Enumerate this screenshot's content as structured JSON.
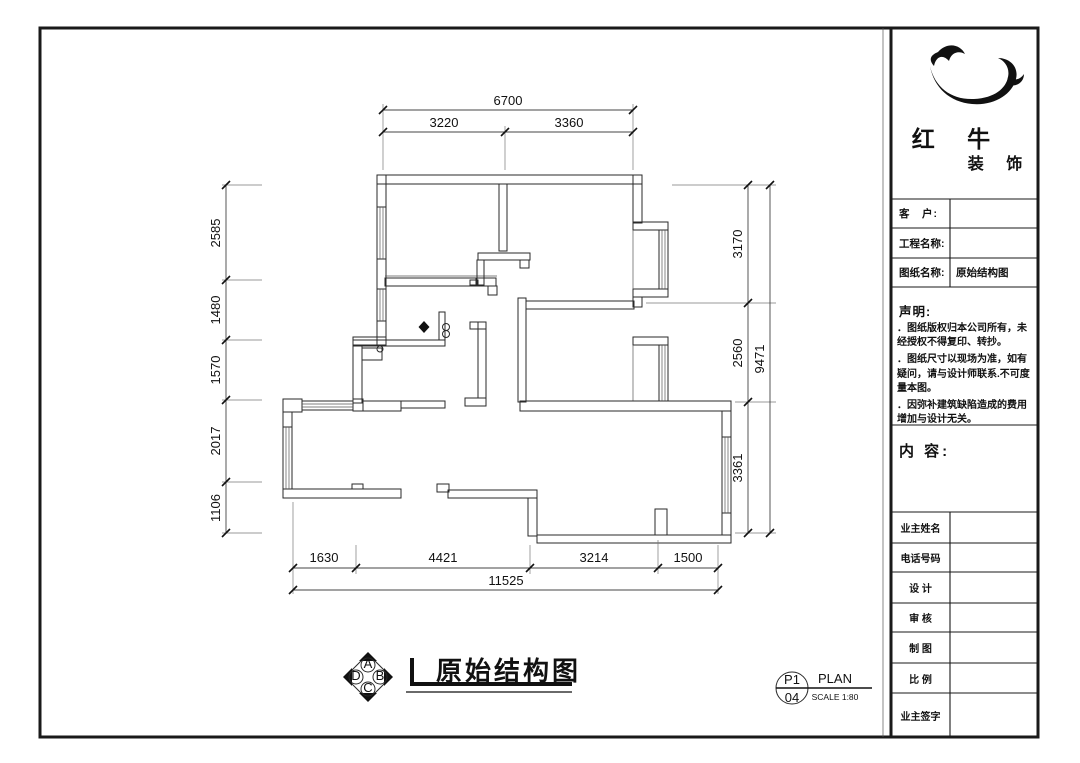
{
  "dims": {
    "top_total": "6700",
    "top_segments": [
      "3220",
      "3360"
    ],
    "left_segments": [
      "2585",
      "1480",
      "1570",
      "2017",
      "1106"
    ],
    "right_segments": [
      "3170",
      "2560",
      "3361"
    ],
    "right_total": "9471",
    "bottom_segments": [
      "1630",
      "4421",
      "3214",
      "1500"
    ],
    "bottom_total": "11525"
  },
  "footer": {
    "title": "原始结构图",
    "marker": {
      "page": "P1",
      "number": "04",
      "type": "PLAN",
      "scale": "SCALE 1:80"
    },
    "compass": {
      "top": "A",
      "right": "B",
      "bottom": "C",
      "left": "D"
    }
  },
  "title_block": {
    "company": {
      "name": "红 牛",
      "suffix": "装 饰"
    },
    "client_label": "客　户:",
    "project_label": "工程名称:",
    "drawing_label": "图纸名称:",
    "drawing_value": "原始结构图",
    "statement_heading": "声明:",
    "statement_items": [
      "．图纸版权归本公司所有，未经授权不得复印、转抄。",
      "．图纸尺寸以现场为准，如有疑问，请与设计师联系.不可度量本图。",
      "．因弥补建筑缺陷造成的费用增加与设计无关。"
    ],
    "content_label": "内 容:",
    "owner_name_label": "业主姓名",
    "phone_label": "电话号码",
    "design_label": "设 计",
    "review_label": "审 核",
    "draft_label": "制 图",
    "scale_label": "比 例",
    "signature_label": "业主签字"
  }
}
